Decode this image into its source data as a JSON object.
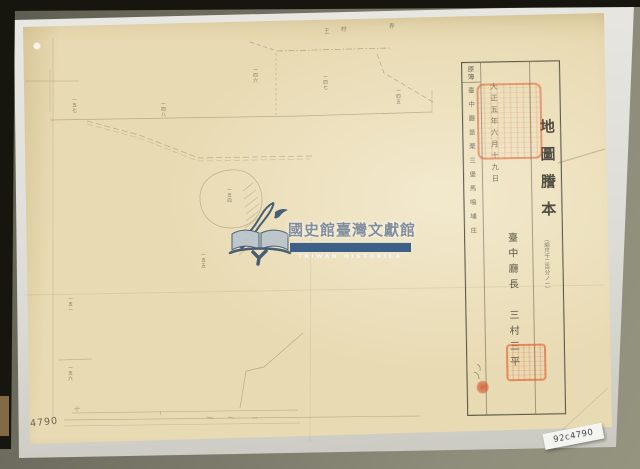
{
  "colors": {
    "seal_red": "#d9552e",
    "watermark_navy": "#2b486a",
    "watermark_text_gray": "#7c8997",
    "paper_beige": "#e8dab2",
    "scanner_bed": "#7e7d6d"
  },
  "catalog": {
    "slip_number": "92c4790",
    "pencil_number": "4790"
  },
  "watermark": {
    "org_zh": "國史館臺灣文獻館",
    "org_en": "TAIWAN HISTORICA"
  },
  "certificate": {
    "title": "地圖謄本",
    "scale_note": "（縮尺千二百分ノ一）",
    "register_header": "原簿",
    "location": "臺中廳苗栗三堡馬鳴埔庄",
    "date": "大正五年六月十九日",
    "issuer": "臺中廳長　三村三平"
  },
  "map": {
    "boundary_labels": [
      {
        "text": "王"
      },
      {
        "text": "村"
      },
      {
        "text": "界"
      }
    ],
    "plot_labels": [
      {
        "text": "一五七"
      },
      {
        "text": "一四八"
      },
      {
        "text": "一四六"
      },
      {
        "text": "一四七"
      },
      {
        "text": "一四五"
      },
      {
        "text": "一五四"
      },
      {
        "text": "一五五"
      },
      {
        "text": "一五一"
      },
      {
        "text": "一五六"
      }
    ]
  }
}
